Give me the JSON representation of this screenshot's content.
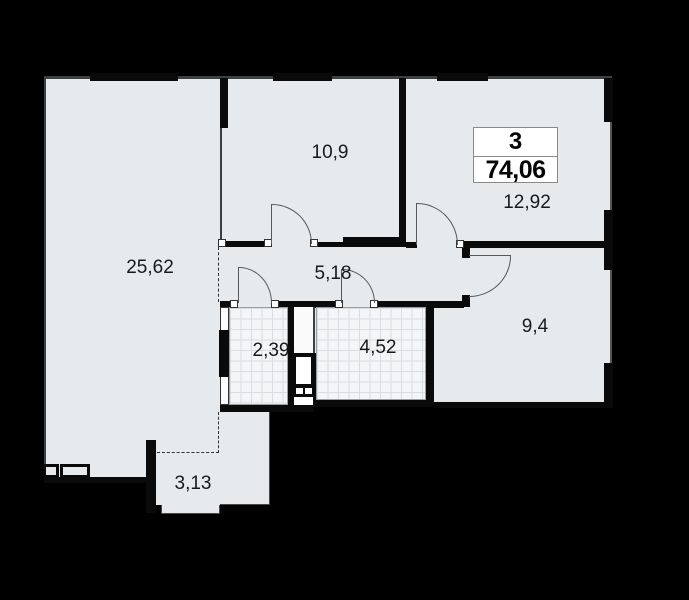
{
  "plan": {
    "title": "apartment-floor-plan",
    "badge": {
      "rooms_count": "3",
      "total_area": "74,06"
    },
    "rooms": {
      "living": {
        "area": "25,62"
      },
      "bedroom_top": {
        "area": "10,9"
      },
      "bedroom_right": {
        "area": "12,92"
      },
      "hallway": {
        "area": "5,18"
      },
      "wc": {
        "area": "2,39"
      },
      "bathroom": {
        "area": "4,52"
      },
      "bedroom_small": {
        "area": "9,4"
      },
      "balcony": {
        "area": "3,13"
      }
    },
    "colors": {
      "background": "#000000",
      "floor": "#e7eaed",
      "wall": "#0a0a0a",
      "tile": "#f4f5f7",
      "tile_grid": "#d9dce0",
      "badge_bg": "#ffffff",
      "label": "#191919"
    }
  }
}
